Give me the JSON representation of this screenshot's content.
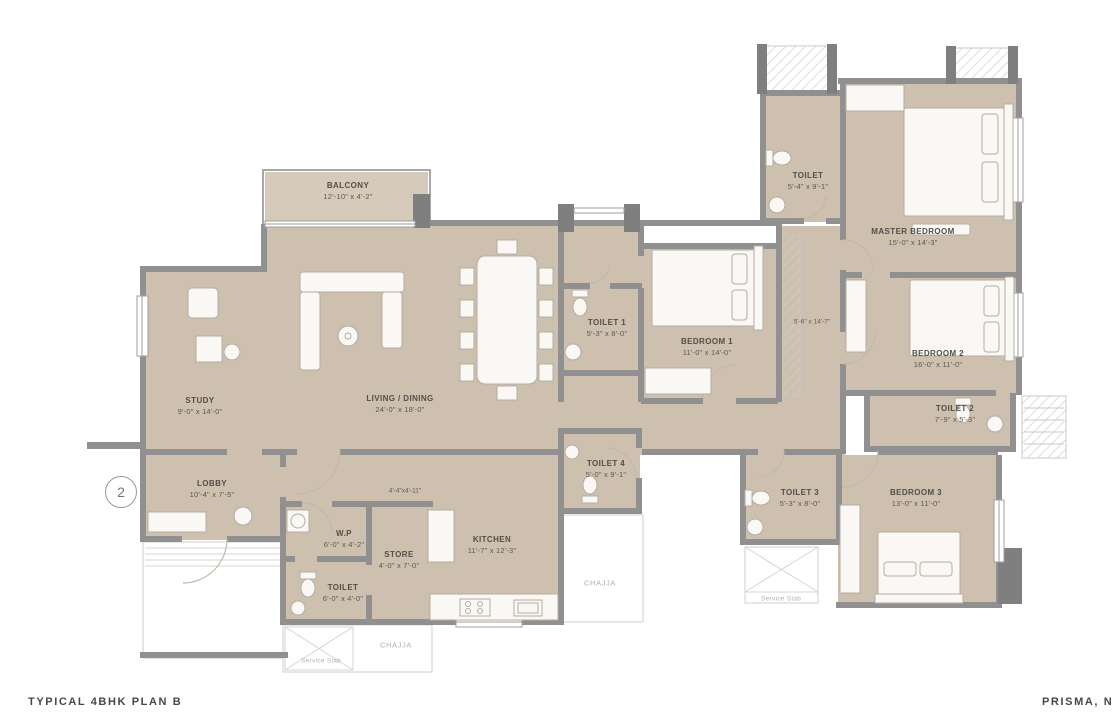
{
  "footer": {
    "left_title": "TYPICAL 4BHK PLAN B",
    "right_title": "PRISMA, N"
  },
  "marker": {
    "number": "2"
  },
  "colors": {
    "floor": "#cec0af",
    "balcony_floor": "#d6cabb",
    "wall": "#909090",
    "label_text": "#524e48",
    "muted_text": "#b3b0ac"
  },
  "rooms": {
    "balcony": {
      "name": "BALCONY",
      "dims": "12'-10\" x 4'-2\""
    },
    "study": {
      "name": "STUDY",
      "dims": "9'-0\" x 14'-0\""
    },
    "living": {
      "name": "LIVING / DINING",
      "dims": "24'-0\" x 18'-0\""
    },
    "lobby": {
      "name": "LOBBY",
      "dims": "10'-4\" x 7'-5\""
    },
    "toilet1": {
      "name": "TOILET 1",
      "dims": "5'-3\" x 8'-0\""
    },
    "bedroom1": {
      "name": "BEDROOM 1",
      "dims": "11'-0\" x 14'-0\""
    },
    "toilet_master": {
      "name": "TOILET",
      "dims": "5'-4\" x 9'-1\""
    },
    "master_bedroom": {
      "name": "MASTER BEDROOM",
      "dims": "15'-0\" x 14'-3\""
    },
    "bedroom2": {
      "name": "BEDROOM 2",
      "dims": "16'-0\" x 11'-0\""
    },
    "toilet2": {
      "name": "TOILET 2",
      "dims": "7'-9\" x 5'-3\""
    },
    "toilet3": {
      "name": "TOILET 3",
      "dims": "5'-3\" x 8'-0\""
    },
    "toilet4": {
      "name": "TOILET 4",
      "dims": "5'-0\" x 9'-1\""
    },
    "bedroom3": {
      "name": "BEDROOM 3",
      "dims": "13'-0\" x 11'-0\""
    },
    "kitchen": {
      "name": "KITCHEN",
      "dims": "11'-7\" x 12'-3\""
    },
    "store": {
      "name": "STORE",
      "dims": "4'-0\" x 7'-0\""
    },
    "wp": {
      "name": "W.P",
      "dims": "6'-0\" x 4'-2\""
    },
    "toilet_common": {
      "name": "TOILET",
      "dims": "6'-0\" x 4'-0\""
    }
  },
  "passages": {
    "p1": {
      "dims": "5'-6\" x 14'-7\""
    },
    "p2": {
      "dims": "4'-4\"x4'-11\""
    }
  },
  "annotations": {
    "chajja": "CHAJJA",
    "service_slab": "Service Slab"
  }
}
